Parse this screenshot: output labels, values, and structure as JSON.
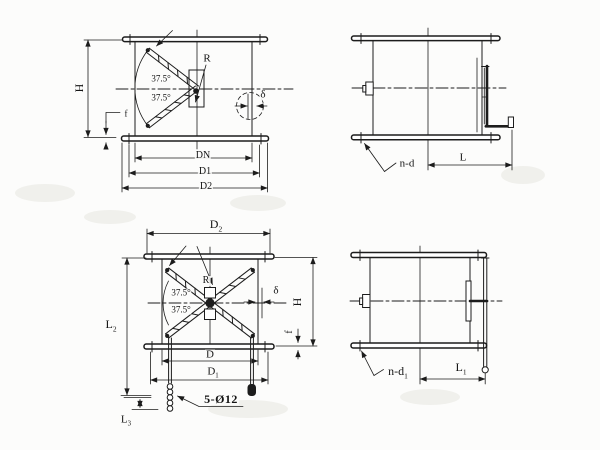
{
  "palette": {
    "line": "#1c1c1c",
    "background": "#fcfcfb",
    "text": "#141414"
  },
  "views": {
    "top_left": {
      "dim_h": "H",
      "dim_f": "f",
      "angle_upper": "37.5°",
      "angle_lower": "37.5°",
      "radius": "R",
      "thickness": "δ",
      "dim_dn": "DN",
      "dim_d1": "D1",
      "dim_d2": "D2"
    },
    "top_right": {
      "holes_note": "n-d",
      "dim_l": "L"
    },
    "bottom_left": {
      "dim_d2": {
        "base": "D",
        "sub": "2"
      },
      "dim_l2": {
        "base": "L",
        "sub": "2"
      },
      "dim_l3": {
        "base": "L",
        "sub": "3"
      },
      "radius": "R",
      "angle_upper": "37.5°",
      "angle_lower": "37.5°",
      "thickness": "δ",
      "dim_h": "H",
      "dim_f": "f",
      "dim_d": "D",
      "dim_d1": {
        "base": "D",
        "sub": "1"
      },
      "holes_note": "5-Ø12"
    },
    "bottom_right": {
      "holes_note": {
        "base": "n-d",
        "sub": "1"
      },
      "dim_l1": {
        "base": "L",
        "sub": "1"
      }
    }
  }
}
